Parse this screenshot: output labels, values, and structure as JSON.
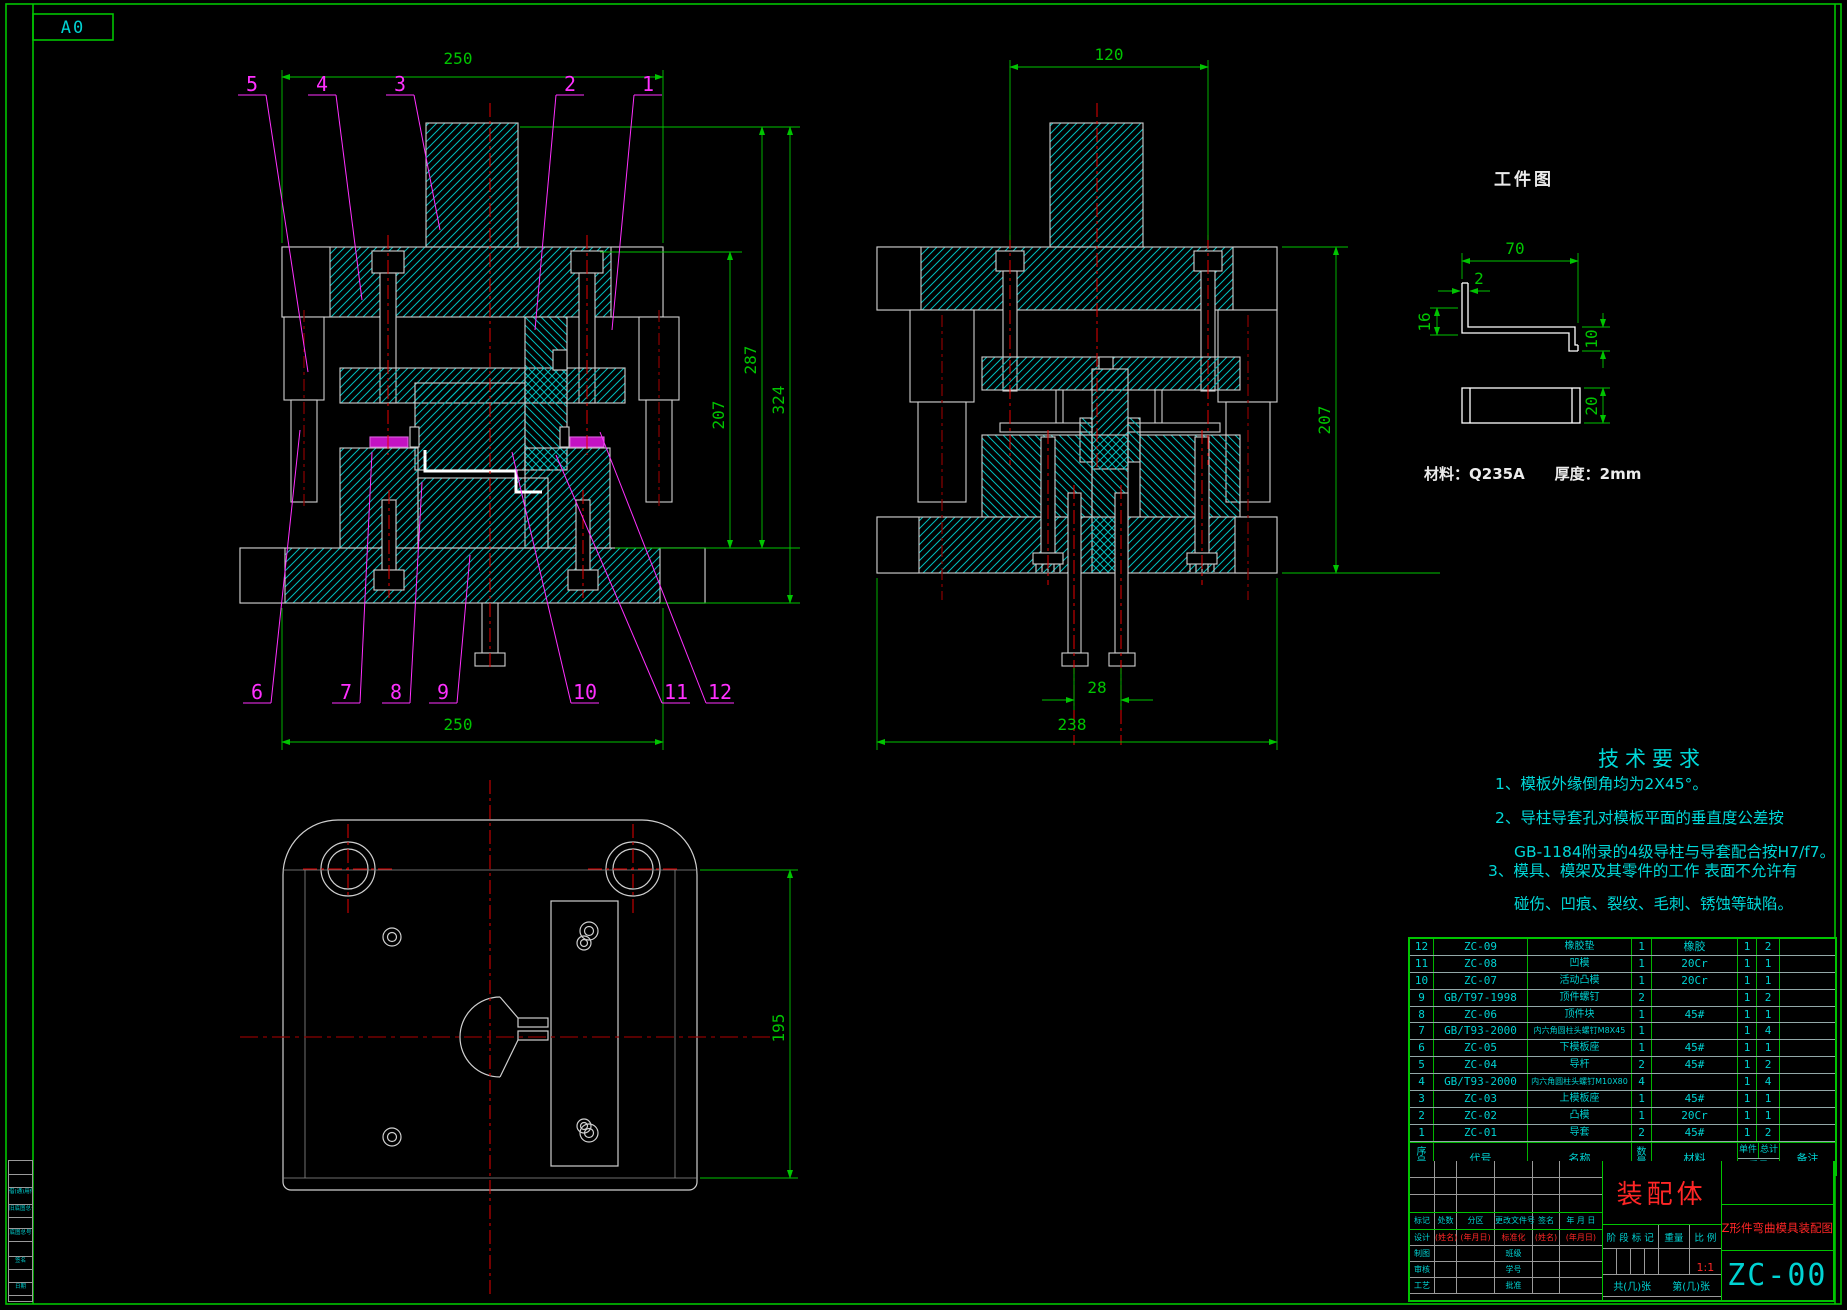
{
  "sheet": {
    "size_label": "A0"
  },
  "front_view": {
    "dim_top_width": "250",
    "dim_height_inner": "207",
    "dim_height_mid": "287",
    "dim_height_outer": "324",
    "dim_bottom_width": "250",
    "callouts_top": [
      "5",
      "4",
      "3",
      "2",
      "1"
    ],
    "callouts_bottom": [
      "6",
      "7",
      "8",
      "9",
      "10",
      "11",
      "12"
    ]
  },
  "side_view": {
    "dim_top_width": "120",
    "dim_height": "207",
    "dim_bolt_spacing": "28",
    "dim_bottom_width": "238"
  },
  "plan_view": {
    "dim_height": "195"
  },
  "workpiece": {
    "title": "工件图",
    "dim_width": "70",
    "dim_thickness": "2",
    "dim_flange_left": "16",
    "dim_flange_right": "10",
    "dim_blank_height": "20",
    "material_note": "材料：Q235A　　厚度：2mm"
  },
  "tech_req": {
    "title": "技术要求",
    "lines": [
      "1、模板外缘倒角均为2X45°。",
      "2、导柱导套孔对模板平面的垂直度公差按",
      "GB-1184附录的4级导柱与导套配合按H7/f7。",
      "3、模具、模架及其零件的工作 表面不允许有",
      "碰伤、凹痕、裂纹、毛刺、锈蚀等缺陷。"
    ]
  },
  "bom": {
    "headers": {
      "seq": "序号",
      "code": "代号",
      "name": "名称",
      "qty": "数量",
      "material": "材料",
      "unit": "单件",
      "total": "总计",
      "weight": "重量",
      "note": "备注"
    },
    "rows": [
      {
        "seq": "12",
        "code": "ZC-09",
        "name": "橡胶垫",
        "qty": "1",
        "material": "橡胶",
        "unit": "1",
        "total": "2",
        "note": ""
      },
      {
        "seq": "11",
        "code": "ZC-08",
        "name": "凹模",
        "qty": "1",
        "material": "20Cr",
        "unit": "1",
        "total": "1",
        "note": ""
      },
      {
        "seq": "10",
        "code": "ZC-07",
        "name": "活动凸模",
        "qty": "1",
        "material": "20Cr",
        "unit": "1",
        "total": "1",
        "note": ""
      },
      {
        "seq": "9",
        "code": "GB/T97-1998",
        "name": "顶件螺钉",
        "qty": "2",
        "material": "",
        "unit": "1",
        "total": "2",
        "note": ""
      },
      {
        "seq": "8",
        "code": "ZC-06",
        "name": "顶件块",
        "qty": "1",
        "material": "45#",
        "unit": "1",
        "total": "1",
        "note": ""
      },
      {
        "seq": "7",
        "code": "GB/T93-2000",
        "name": "内六角圆柱头螺钉M8X45",
        "qty": "1",
        "material": "",
        "unit": "1",
        "total": "4",
        "note": ""
      },
      {
        "seq": "6",
        "code": "ZC-05",
        "name": "下模板座",
        "qty": "1",
        "material": "45#",
        "unit": "1",
        "total": "1",
        "note": ""
      },
      {
        "seq": "5",
        "code": "ZC-04",
        "name": "导杆",
        "qty": "2",
        "material": "45#",
        "unit": "1",
        "total": "2",
        "note": ""
      },
      {
        "seq": "4",
        "code": "GB/T93-2000",
        "name": "内六角圆柱头螺钉M10X80",
        "qty": "4",
        "material": "",
        "unit": "1",
        "total": "4",
        "note": ""
      },
      {
        "seq": "3",
        "code": "ZC-03",
        "name": "上模板座",
        "qty": "1",
        "material": "45#",
        "unit": "1",
        "total": "1",
        "note": ""
      },
      {
        "seq": "2",
        "code": "ZC-02",
        "name": "凸模",
        "qty": "1",
        "material": "20Cr",
        "unit": "1",
        "total": "1",
        "note": ""
      },
      {
        "seq": "1",
        "code": "ZC-01",
        "name": "导套",
        "qty": "2",
        "material": "45#",
        "unit": "1",
        "total": "2",
        "note": ""
      }
    ]
  },
  "title_block": {
    "assembly_name": "装配体",
    "drawing_name": "Z形件弯曲模具装配图",
    "drawing_no": "ZC-00",
    "scale_value": "1:1",
    "stage_label": "阶 段 标 记",
    "weight_label": "重量",
    "scale_label": "比 例",
    "sheets_total": "共(几)张",
    "sheet_no": "第(几)张",
    "revision_headers": [
      "标记",
      "处数",
      "分区",
      "更改文件号",
      "签名",
      "年 月 日"
    ],
    "sig": {
      "design": "设计",
      "design_name": "(姓名)",
      "design_date": "(年月日)",
      "standard": "标准化",
      "std_name": "(姓名)",
      "std_date": "(年月日)",
      "draft": "制图",
      "klass": "班级",
      "check": "审核",
      "stu_no": "学号",
      "process": "工艺",
      "approve": "批准"
    }
  },
  "left_strip": {
    "labels": [
      "借(通)用件登记",
      "旧底图总号",
      "底图总号",
      "签名",
      "日期"
    ]
  }
}
